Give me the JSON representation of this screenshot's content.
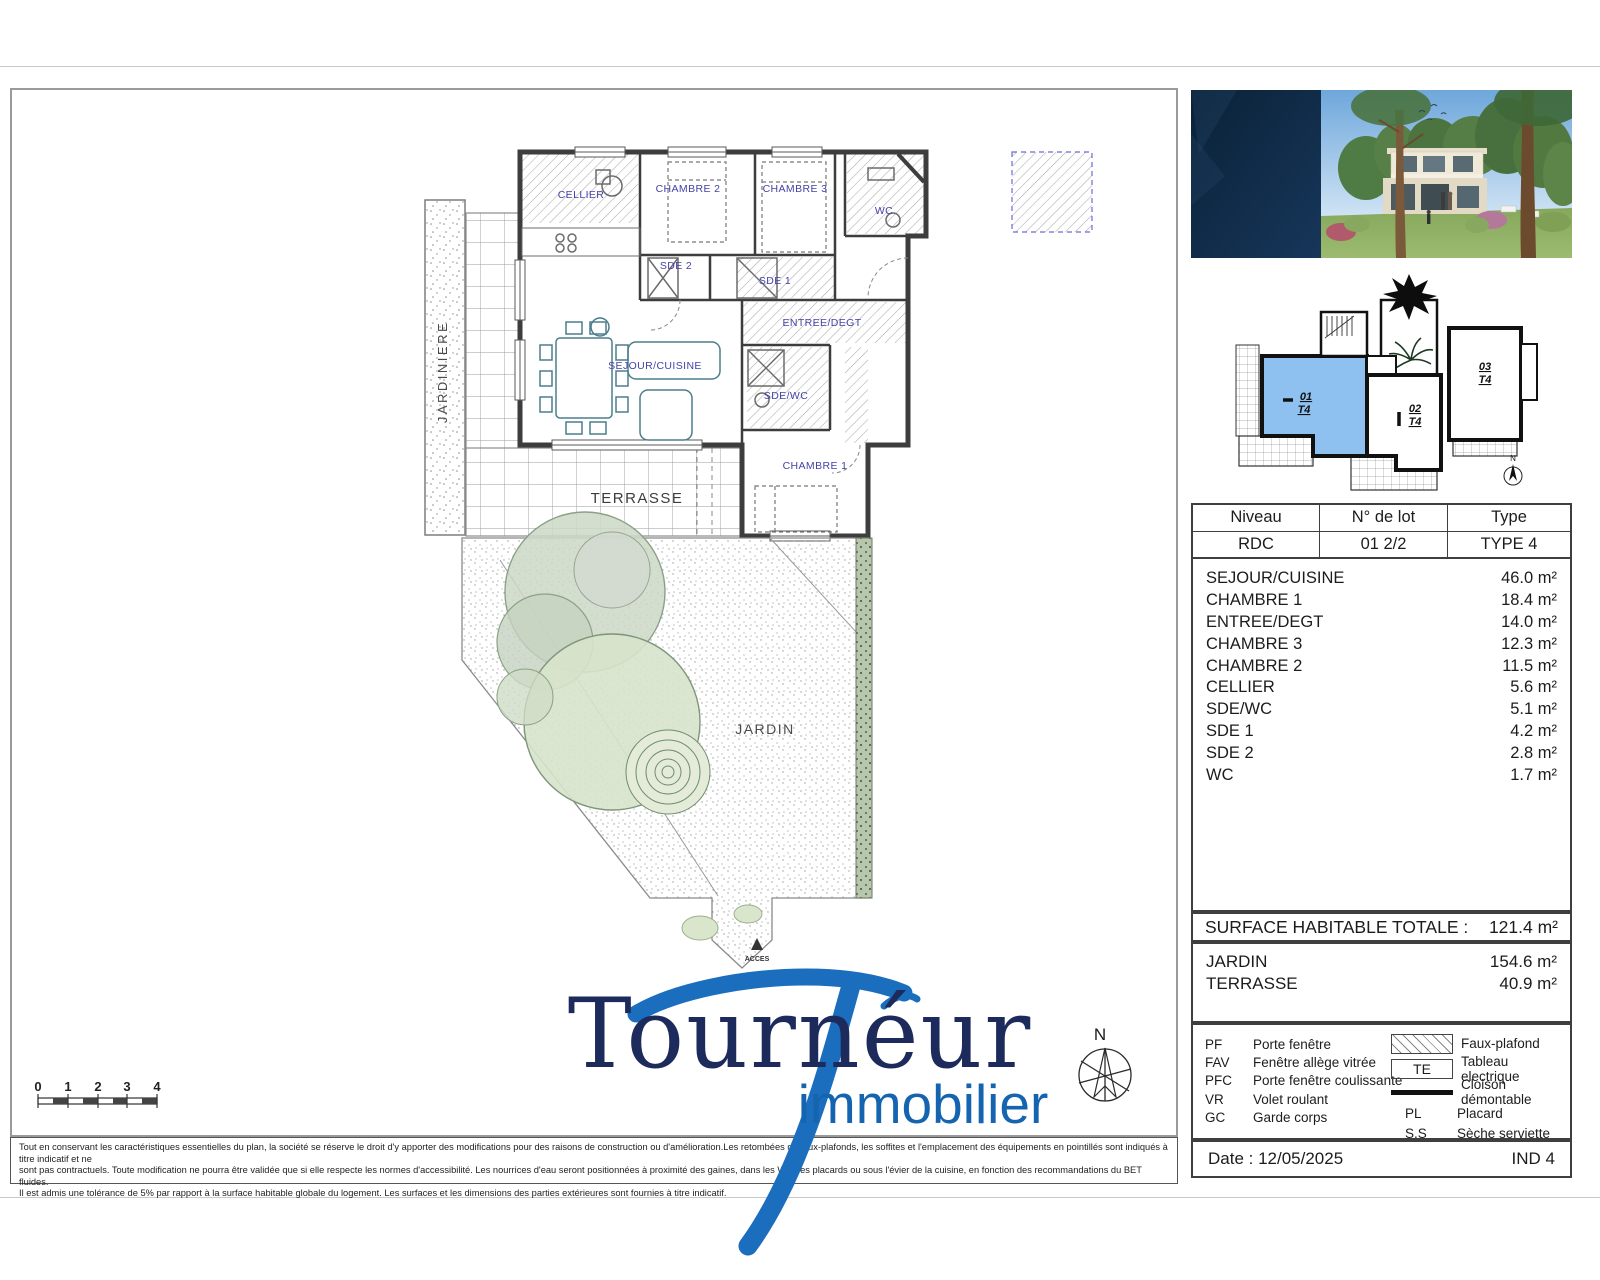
{
  "colors": {
    "logo_navy": "#1d2a5c",
    "logo_blue": "#1a6ebd",
    "plan_label_blue": "#4343a8",
    "unit_highlight": "#8ec1f0"
  },
  "plan": {
    "rooms": [
      {
        "label": "CELLIER"
      },
      {
        "label": "CHAMBRE 2"
      },
      {
        "label": "CHAMBRE 3"
      },
      {
        "label": "WC"
      },
      {
        "label": "SDE 2"
      },
      {
        "label": "SDE 1"
      },
      {
        "label": "ENTREE/DEGT"
      },
      {
        "label": "SEJOUR/CUISINE"
      },
      {
        "label": "SDE/WC"
      },
      {
        "label": "CHAMBRE 1"
      }
    ],
    "outdoor": {
      "jardiniere": "JARDINIERE",
      "terrasse": "TERRASSE",
      "jardin": "JARDIN",
      "acces": "ACCES"
    },
    "scale_ticks": [
      "0",
      "1",
      "2",
      "3",
      "4"
    ],
    "north_label": "N"
  },
  "sidebar": {
    "key_plan": {
      "units": [
        {
          "id": "01",
          "type": "T4"
        },
        {
          "id": "02",
          "type": "T4"
        },
        {
          "id": "03",
          "type": "T4"
        }
      ],
      "north_label": "N"
    },
    "lot_table": {
      "headers": [
        "Niveau",
        "N° de lot",
        "Type"
      ],
      "values": [
        "RDC",
        "01 2/2",
        "TYPE 4"
      ]
    },
    "rooms": [
      {
        "label": "SEJOUR/CUISINE",
        "area": "46.0 m²"
      },
      {
        "label": "CHAMBRE 1",
        "area": "18.4 m²"
      },
      {
        "label": "ENTREE/DEGT",
        "area": "14.0 m²"
      },
      {
        "label": "CHAMBRE 3",
        "area": "12.3 m²"
      },
      {
        "label": "CHAMBRE 2",
        "area": "11.5 m²"
      },
      {
        "label": "CELLIER",
        "area": "5.6 m²"
      },
      {
        "label": "SDE/WC",
        "area": "5.1 m²"
      },
      {
        "label": "SDE 1",
        "area": "4.2 m²"
      },
      {
        "label": "SDE 2",
        "area": "2.8 m²"
      },
      {
        "label": "WC",
        "area": "1.7 m²"
      }
    ],
    "totals": {
      "surface_label": "SURFACE HABITABLE TOTALE :",
      "surface_value": "121.4 m²",
      "outdoor": [
        {
          "label": "JARDIN",
          "area": "154.6 m²"
        },
        {
          "label": "TERRASSE",
          "area": "40.9 m²"
        }
      ]
    },
    "legend": {
      "abbreviations": [
        {
          "code": "PF",
          "label": "Porte fenêtre"
        },
        {
          "code": "FAV",
          "label": "Fenêtre allège vitrée"
        },
        {
          "code": "PFC",
          "label": "Porte fenêtre coulissante"
        },
        {
          "code": "VR",
          "label": "Volet roulant"
        },
        {
          "code": "GC",
          "label": "Garde corps"
        }
      ],
      "symbols": {
        "faux_plafond": "Faux-plafond",
        "te_code": "TE",
        "te_label": "Tableau electrique",
        "cloison": "Cloison démontable",
        "pl_code": "PL",
        "pl_label": "Placard",
        "ss_code": "S.S",
        "ss_label": "Sèche serviette"
      }
    },
    "footer": {
      "date": "Date : 12/05/2025",
      "index": "IND 4"
    }
  },
  "branding": {
    "name": "Tournéur",
    "tagline": "immobilier"
  },
  "disclaimer": {
    "line1": "Tout en conservant les caractéristiques essentielles du plan, la société se réserve le droit d'y apporter des modifications pour des raisons de construction ou d'amélioration.Les retombées de faux-plafonds, les soffites et l'emplacement des équipements en pointillés sont indiqués à titre indicatif et ne",
    "line2": "sont pas contractuels. Toute modification ne pourra être validée que si elle respecte les normes d'accessibilité. Les nourrices d'eau seront positionnées à proximité des gaines, dans les WC, les placards ou sous l'évier de la cuisine, en fonction des recommandations du BET fluides.",
    "line3": "Il est admis une tolérance de 5% par rapport à la surface habitable globale du logement. Les surfaces et les dimensions des parties extérieures sont fournies à titre indicatif."
  }
}
